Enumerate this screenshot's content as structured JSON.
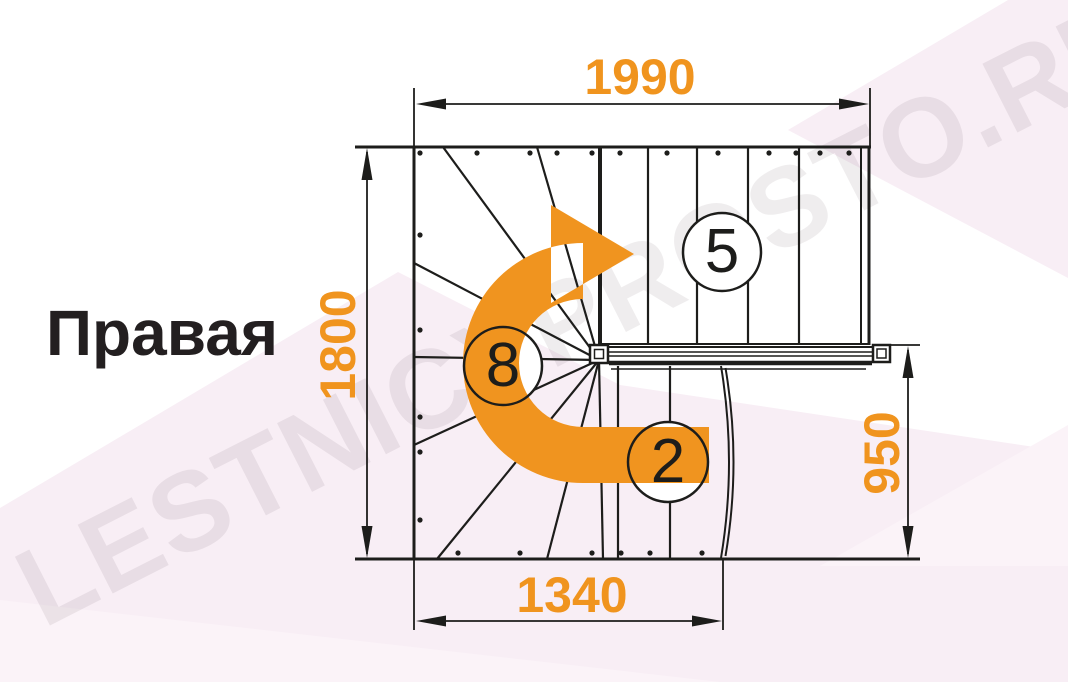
{
  "title": "Правая",
  "watermark": "LESTNICYPROSTO.RU",
  "dimensions": {
    "top_width_mm": "1990",
    "total_depth_mm": "1800",
    "lower_flight_depth_mm": "950",
    "bottom_width_mm": "1340"
  },
  "step_labels": {
    "top_flight_steps": "5",
    "winder_steps": "8",
    "bottom_flight_steps": "2"
  },
  "colors": {
    "accent_orange": "#F0941F",
    "line_black": "#1d1d1b",
    "background_pink": "#f8eef5",
    "background_pink_light": "#fbf3f8",
    "circle_fill": "#ffffff"
  }
}
